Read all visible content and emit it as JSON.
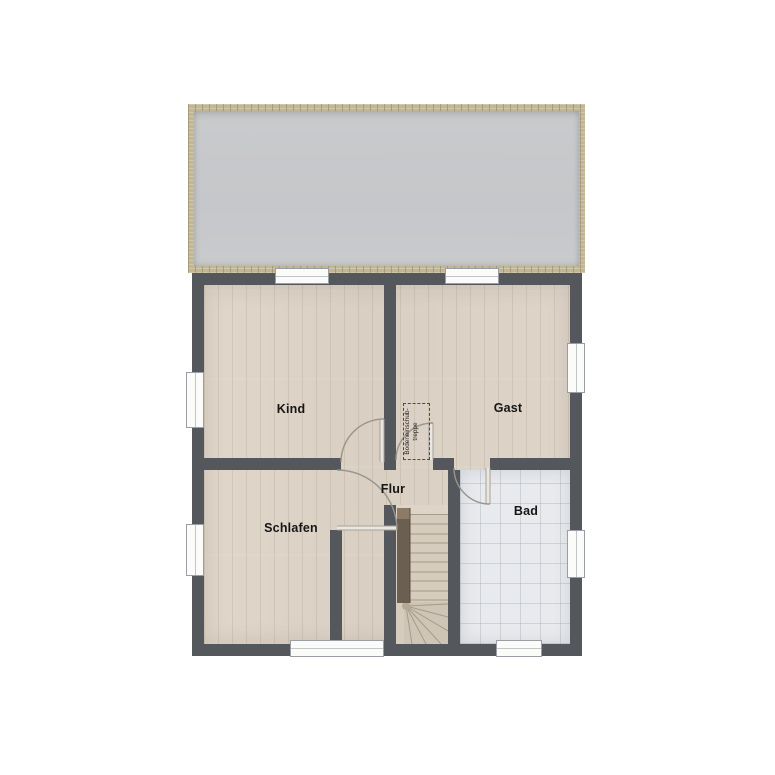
{
  "plan": {
    "title": "upper-floor-plan",
    "rooms": {
      "kind": {
        "label": "Kind"
      },
      "gast": {
        "label": "Gast"
      },
      "flur": {
        "label": "Flur"
      },
      "schlafen": {
        "label": "Schlafen"
      },
      "bad": {
        "label": "Bad"
      }
    },
    "annotations": {
      "attic_hatch": {
        "line1": "Bodeneinschub-",
        "line2": "treppe"
      }
    },
    "icons": {
      "staircase": "winder-staircase",
      "attic_hatch_box": "dashed-ceiling-hatch",
      "plants": "potted-plant",
      "bathroom": [
        "washbasin",
        "toilet",
        "bathtub",
        "sink",
        "towel",
        "stool"
      ]
    },
    "colors": {
      "wall": "#54575b",
      "roof": "#c8c9cb",
      "roof_trim": "#c2b795",
      "wood_floor": "#ddd3c7",
      "tile_floor": "#e8eaed",
      "rug": "#d4caa4",
      "accent_orange": "#e5a352",
      "accent_green": "#aecb9e",
      "plant_green": "#74a844"
    }
  }
}
